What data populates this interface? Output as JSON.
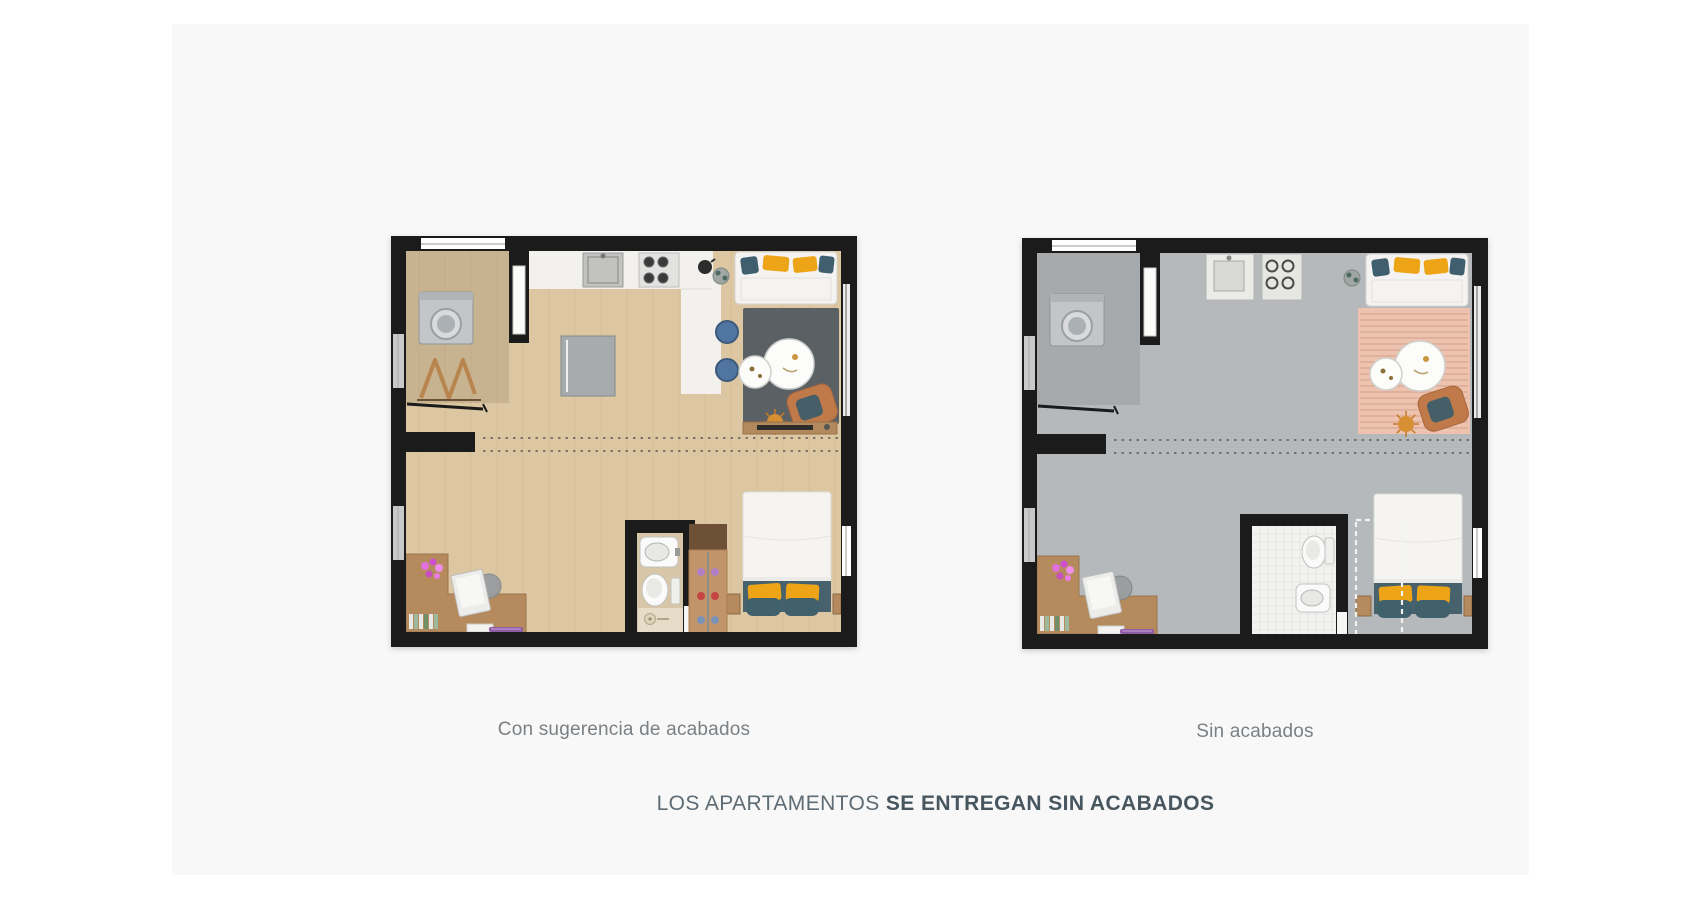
{
  "page": {
    "background": "#ffffff",
    "panel_bg": "#f8f8f8"
  },
  "headline": {
    "regular": "LOS APARTAMENTOS ",
    "bold": "SE ENTREGAN SIN ACABADOS"
  },
  "text_colors": {
    "caption": "#7b8084",
    "headline_regular": "#5d6b74",
    "headline_bold": "#47565f"
  },
  "plans": [
    {
      "id": "finished",
      "caption": "Con sugerencia de acabados",
      "features": {
        "kitchen": "finished",
        "rug_style": "solid",
        "wardrobe": "solid",
        "bathroom": "finished",
        "drying_rack": true,
        "sideboard": true,
        "floor_planks": true
      },
      "colors": {
        "wall": "#1b1b1b",
        "floor": "#ddc7a2",
        "floor_streak": "#cbb189",
        "laundry_shade": "rgba(80,60,40,0.14)",
        "counter": "#f2f1ee",
        "rug": "#5b6064",
        "rug_stripe": "",
        "sofa": "#f4f3f1",
        "pillow_teal": "#3f5f6e",
        "pillow_yellow": "#eda517",
        "table": "#fcfcfb",
        "armchair": "#c07a4a",
        "armchair_cushion": "#455e67",
        "fridge": "#a7abad",
        "stool": "#4f75a0",
        "bath_floor": "#d8c6a8",
        "bath_grid": "",
        "bath_fixture": "#fafafa",
        "shower": "#e6dcc7",
        "wardrobe_shelf": "#6e5037",
        "wardrobe_body": "#c2946a",
        "wardrobe_dash": "",
        "desk": "#b58a5c",
        "bed_duvet": "#f5f4f1",
        "bed_base": "#47626d",
        "nightstand": "#b58a5f",
        "appliance": "#c3c6c8",
        "glass_window": "#c9c9c9",
        "dash_line": "#4a4a4a"
      }
    },
    {
      "id": "unfinished",
      "caption": "Sin acabados",
      "features": {
        "kitchen": "bare",
        "rug_style": "striped",
        "wardrobe": "dashed",
        "bathroom": "bare",
        "drying_rack": false,
        "sideboard": false,
        "floor_planks": false
      },
      "colors": {
        "wall": "#1b1b1b",
        "floor": "#b6b9bb",
        "floor_streak": "",
        "laundry_shade": "rgba(40,40,45,0.10)",
        "counter": "",
        "rug": "#edc2af",
        "rug_stripe": "#d9a692",
        "sofa": "#f4f3f1",
        "pillow_teal": "#3f5f6e",
        "pillow_yellow": "#eda517",
        "table": "#fcfcfb",
        "armchair": "#c07a4a",
        "armchair_cushion": "#455e67",
        "fridge": "",
        "stool": "",
        "bath_floor": "#f2f2f0",
        "bath_grid": "#e2e2e0",
        "bath_fixture": "#fafafa",
        "shower": "#ececea",
        "wardrobe_shelf": "",
        "wardrobe_body": "",
        "wardrobe_dash": "#f1f1ef",
        "desk": "#b58a5c",
        "bed_duvet": "#f5f4f1",
        "bed_base": "#47626d",
        "nightstand": "#b58a5f",
        "appliance": "#c3c6c8",
        "glass_window": "#c9c9c9",
        "dash_line": "#4a4a4a"
      }
    }
  ]
}
